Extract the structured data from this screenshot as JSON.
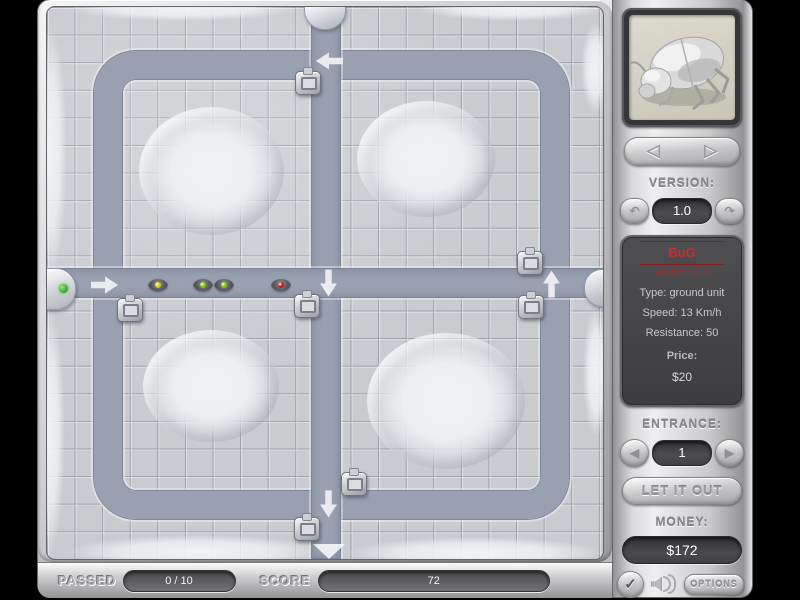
{
  "colors": {
    "path": "#99a1b0",
    "tile": "#c9cbcf",
    "accent_red": "#c23030",
    "entrance_dot_green": "#3db83d"
  },
  "sidebar": {
    "portrait": "beetle-unit",
    "icons": {
      "nav_prev": "◁",
      "nav_next": "▷",
      "version_down": "↶",
      "version_up": "↷",
      "entrance_prev": "◀",
      "entrance_next": "▶",
      "check": "✓"
    },
    "version_label": "VERSION:",
    "version_value": "1.0",
    "info": {
      "name": "BuG",
      "version_line": "version 1.0",
      "type_line": "Type: ground unit",
      "speed_line": "Speed: 13 Km/h",
      "resistance_line": "Resistance: 50",
      "price_label": "Price:",
      "price_value": "$20"
    },
    "entrance_label": "ENTRANCE:",
    "entrance_value": "1",
    "let_it_out_label": "LET IT OUT",
    "money_label": "MONEY:",
    "money_value": "$172",
    "options_label": "OPTIONS"
  },
  "status_bar": {
    "passed_label": "PASSED",
    "passed_value": "0 / 10",
    "score_label": "SCORE",
    "score_value": "72"
  },
  "board": {
    "mounds": [
      {
        "x": 164,
        "y": 164,
        "w": 145,
        "h": 128
      },
      {
        "x": 379,
        "y": 152,
        "w": 138,
        "h": 116
      },
      {
        "x": 164,
        "y": 379,
        "w": 136,
        "h": 112
      },
      {
        "x": 399,
        "y": 394,
        "w": 158,
        "h": 136
      }
    ],
    "snow_edges": [
      {
        "x": -14,
        "y": 20,
        "w": 34,
        "h": 250
      },
      {
        "x": -14,
        "y": 300,
        "w": 32,
        "h": 250
      },
      {
        "x": 20,
        "y": 528,
        "w": 260,
        "h": 34
      },
      {
        "x": 300,
        "y": 530,
        "w": 256,
        "h": 32
      },
      {
        "x": 20,
        "y": -12,
        "w": 230,
        "h": 26
      },
      {
        "x": 370,
        "y": -12,
        "w": 190,
        "h": 26
      },
      {
        "x": 534,
        "y": 16,
        "w": 28,
        "h": 90
      },
      {
        "x": 536,
        "y": 300,
        "w": 26,
        "h": 130
      }
    ],
    "towers": [
      {
        "x": 260,
        "y": 75
      },
      {
        "x": 82,
        "y": 302
      },
      {
        "x": 259,
        "y": 298
      },
      {
        "x": 482,
        "y": 255
      },
      {
        "x": 483,
        "y": 299
      },
      {
        "x": 306,
        "y": 476
      },
      {
        "x": 259,
        "y": 521
      }
    ],
    "bugs": [
      {
        "x": 111,
        "y": 278,
        "color": "#d4cc00"
      },
      {
        "x": 156,
        "y": 278,
        "color": "#7ec800"
      },
      {
        "x": 177,
        "y": 278,
        "color": "#7ec800"
      },
      {
        "x": 234,
        "y": 278,
        "color": "#cc1111"
      }
    ],
    "arrows": [
      {
        "x": 57,
        "y": 278,
        "rot": 0
      },
      {
        "x": 282,
        "y": 54,
        "rot": 180
      },
      {
        "x": 281,
        "y": 276,
        "rot": 90
      },
      {
        "x": 504,
        "y": 277,
        "rot": 270
      },
      {
        "x": 281,
        "y": 497,
        "rot": 90
      }
    ]
  }
}
